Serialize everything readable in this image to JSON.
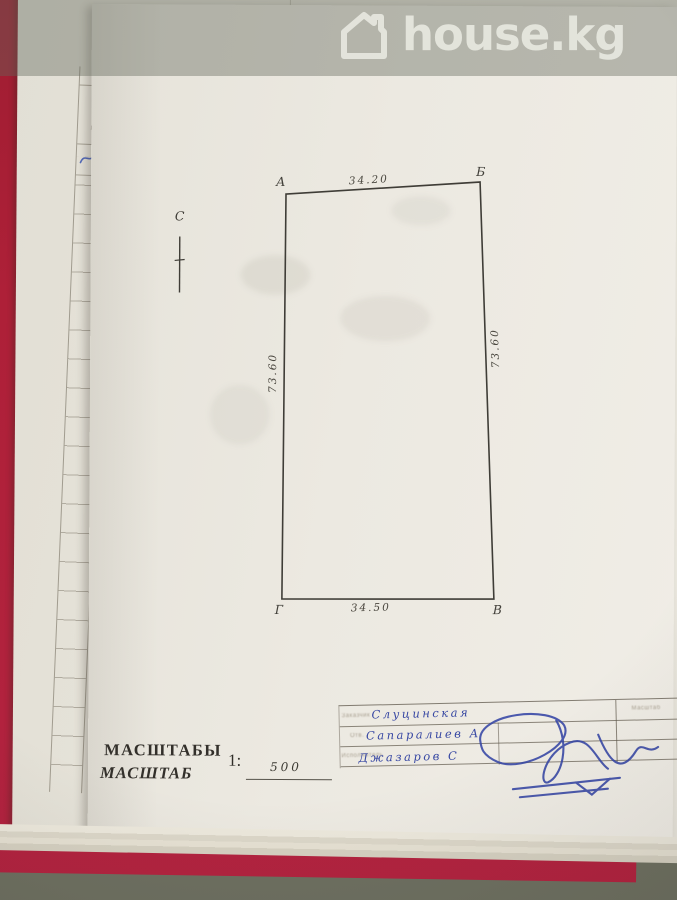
{
  "watermark": {
    "brand": "house.kg"
  },
  "side_ledger": {
    "header": "Литера"
  },
  "plan": {
    "corner_top_left": "А",
    "corner_top_right": "Б",
    "corner_bottom_right": "В",
    "corner_bottom_left": "Г",
    "dim_top": "34.20",
    "dim_bottom": "34.50",
    "dim_left": "73.60",
    "dim_right": "73.60",
    "north_label": "С"
  },
  "scale_block": {
    "title": "МАСШТАБЫ",
    "subtitle": "МАСШТАБ",
    "ratio_prefix": "1:",
    "ratio_value": "500"
  },
  "title_block": {
    "col_header_right": "Масштаб",
    "rows": [
      {
        "label": "Заказчик",
        "value": "Слуцинская"
      },
      {
        "label": "Отв.",
        "value": "Сапаралиев А"
      },
      {
        "label": "Исполнитель",
        "value": "Джазаров С"
      }
    ]
  },
  "colors": {
    "folder_red": "#ac2038",
    "ink_blue": "#3848a3",
    "paper": "#ece9e1",
    "pencil": "#46443d",
    "watermark_text": "#e7e8e0",
    "background": "#6e7061"
  }
}
